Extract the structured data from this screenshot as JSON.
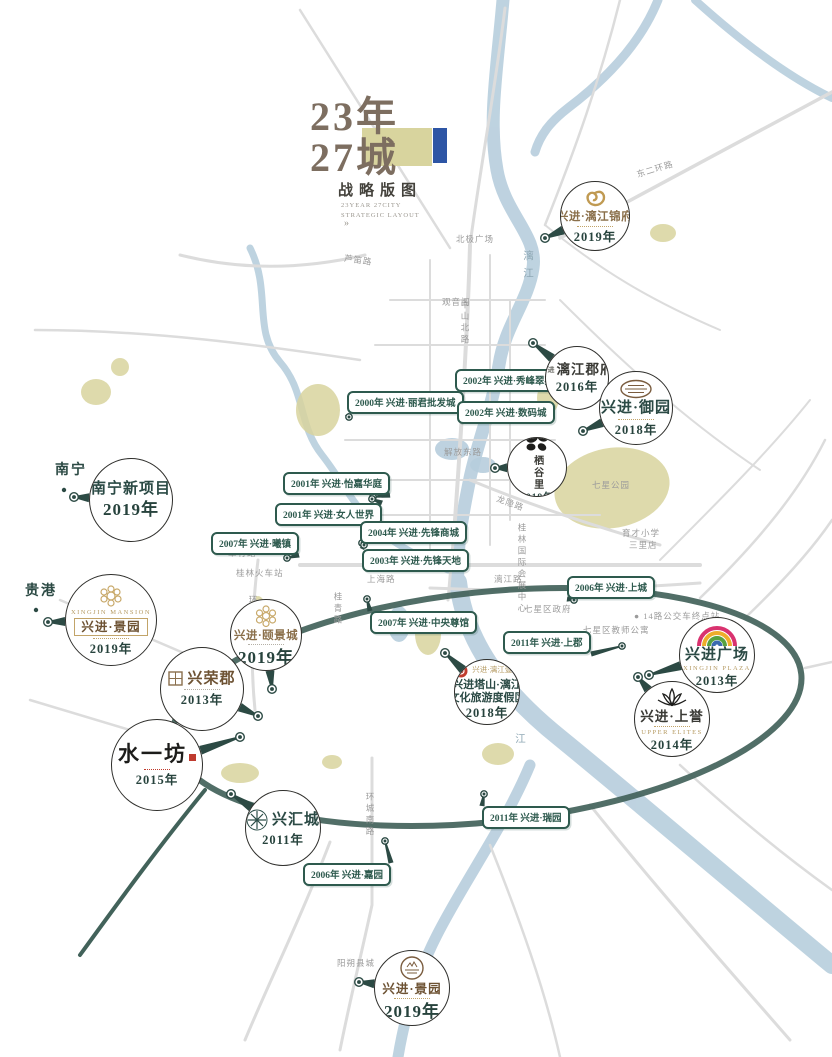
{
  "poster": {
    "title": {
      "line1": "23年",
      "line2": "27城",
      "subtitle": "战略版图",
      "eng_line1": "23YEAR 27CITY",
      "eng_line2": "STRATEGIC LAYOUT",
      "arrow": "»"
    },
    "colors": {
      "accent_teal": "#2c4a44",
      "label_green": "#2e5a4e",
      "khaki": "#d8d49e",
      "blue_bar": "#2d55a5",
      "gold": "#bd9a5f",
      "river_blue": "#b7cedd",
      "ring_road": "#42625a"
    }
  },
  "city_markers": [
    {
      "label": "南宁",
      "x": 55,
      "y": 459,
      "dot": [
        64,
        490
      ]
    },
    {
      "label": "贵港",
      "x": 25,
      "y": 580,
      "dot": [
        36,
        610
      ]
    }
  ],
  "projects": [
    {
      "id": "lijiang-jinfu",
      "name": "兴进·漓江锦府",
      "year": "2019年",
      "logo": "gold-crest-icon",
      "name_class": "callig-gold",
      "deco": "gold",
      "cx": 595,
      "cy": 216,
      "r": 35,
      "anchor": [
        545,
        238
      ]
    },
    {
      "id": "lijiang-junfu",
      "prefix": "兴进",
      "name": "漓江郡府",
      "year": "2016年",
      "logo": "",
      "name_class": "callig-dark",
      "cx": 577,
      "cy": 378,
      "r": 32,
      "anchor": [
        533,
        343
      ]
    },
    {
      "id": "xingjin-yuyuan",
      "name": "兴进·御园",
      "year": "2018年",
      "logo": "ornate-plate-icon",
      "name_class": "teal-big",
      "deco": "gold",
      "cx": 636,
      "cy": 408,
      "r": 37,
      "anchor": [
        583,
        431
      ]
    },
    {
      "id": "qiguli",
      "name": "栖谷里",
      "year": "2019年",
      "logo": "clover-icon",
      "vertical": true,
      "name_class": "callig-dark-small",
      "small_year": true,
      "cx": 537,
      "cy": 467,
      "r": 30,
      "anchor": [
        495,
        468
      ]
    },
    {
      "id": "nanning-new-project",
      "name": "南宁新项目",
      "year": "2019年",
      "logo": "",
      "name_class": "teal-big",
      "year_big": true,
      "cx": 131,
      "cy": 500,
      "r": 42,
      "anchor": [
        74,
        497
      ]
    },
    {
      "id": "guigang-jingyuan",
      "sub_top": "XINGJIN MANSION",
      "name": "兴进·景园",
      "boxed": true,
      "year": "2019年",
      "logo": "rosette-icon",
      "name_class": "callig-brown",
      "deco": "gold",
      "cx": 111,
      "cy": 620,
      "r": 46,
      "anchor": [
        48,
        622
      ]
    },
    {
      "id": "yijingcheng",
      "name": "兴进·颐景城",
      "year": "2019年",
      "logo": "flower-icon",
      "name_class": "callig-gold",
      "deco": "gray",
      "year_big": true,
      "cx": 266,
      "cy": 635,
      "r": 36,
      "anchor": [
        272,
        689
      ]
    },
    {
      "id": "xingrongjun",
      "name": "兴荣郡",
      "year": "2013年",
      "logo": "lattice-icon",
      "logo_row": true,
      "name_class": "brown-big",
      "deco": "gray",
      "cx": 202,
      "cy": 689,
      "r": 42,
      "anchor": [
        258,
        716
      ]
    },
    {
      "id": "shuiyifang",
      "name": "水一坊",
      "year": "2015年",
      "logo": "",
      "name_class": "brush",
      "seal": true,
      "deco": "red",
      "cx": 157,
      "cy": 765,
      "r": 46,
      "anchor": [
        240,
        737
      ]
    },
    {
      "id": "xinghuicheng",
      "name": "兴汇城",
      "year": "2011年",
      "logo": "medallion-icon",
      "logo_row": true,
      "name_class": "teal-big",
      "cx": 283,
      "cy": 828,
      "r": 38,
      "anchor": [
        231,
        794
      ]
    },
    {
      "id": "xingjin-plaza",
      "name": "兴进广场",
      "sub": "XINGJIN PLAZA",
      "year": "2013年",
      "logo": "rainbow-arch-icon",
      "name_class": "teal-big",
      "cx": 717,
      "cy": 655,
      "r": 38,
      "anchor": [
        649,
        675
      ]
    },
    {
      "id": "xingjin-shangyu",
      "name": "兴进·上誉",
      "sub": "UPPER ELITES",
      "year": "2014年",
      "logo": "lotus-icon",
      "name_class": "callig-dark",
      "deco": "gold",
      "cx": 672,
      "cy": 719,
      "r": 38,
      "anchor": [
        638,
        677
      ]
    },
    {
      "id": "tashan-resort",
      "logo": "red-seal-icon",
      "logo_row": true,
      "logo_text": "兴进·漓江壹号",
      "name": "兴进塔山·漓江",
      "name2": "文化旅游度假区",
      "year": "2018年",
      "name_class": "teal-small",
      "cx": 487,
      "cy": 692,
      "r": 33,
      "anchor": [
        445,
        653
      ]
    },
    {
      "id": "yangshuo-jingyuan",
      "name": "兴进·景园",
      "year": "2019年",
      "logo": "emblem-icon",
      "name_class": "callig-brown",
      "deco": "gold",
      "year_big": true,
      "cx": 412,
      "cy": 988,
      "r": 38,
      "anchor": [
        359,
        982
      ]
    }
  ],
  "timeline_labels": [
    {
      "text": "2002年 兴进·秀峰翠苑",
      "x": 455,
      "y": 369,
      "anchor": [
        452,
        398
      ]
    },
    {
      "text": "2000年 兴进·丽君批发城",
      "x": 347,
      "y": 391,
      "anchor": [
        349,
        417
      ]
    },
    {
      "text": "2002年 兴进·数码城",
      "x": 457,
      "y": 401,
      "anchor": [
        453,
        399
      ]
    },
    {
      "text": "2001年 兴进·怡嘉华庭",
      "x": 283,
      "y": 472,
      "anchor": [
        373,
        497
      ]
    },
    {
      "text": "2001年 兴进·女人世界",
      "x": 275,
      "y": 503,
      "anchor": [
        372,
        499
      ]
    },
    {
      "text": "2004年 兴进·先锋商城",
      "x": 360,
      "y": 521,
      "anchor": [
        362,
        543
      ]
    },
    {
      "text": "2003年 兴进·先锋天地",
      "x": 362,
      "y": 549,
      "anchor": [
        364,
        545
      ]
    },
    {
      "text": "2007年 兴进·曦镇",
      "x": 211,
      "y": 532,
      "anchor": [
        287,
        558
      ]
    },
    {
      "text": "2006年 兴进·上城",
      "x": 567,
      "y": 576,
      "anchor": [
        574,
        600
      ]
    },
    {
      "text": "2007年 兴进·中央尊馆",
      "x": 370,
      "y": 611,
      "anchor": [
        367,
        599
      ]
    },
    {
      "text": "2011年 兴进·上郡",
      "x": 503,
      "y": 631,
      "anchor": [
        622,
        646
      ]
    },
    {
      "text": "2011年 兴进·瑞园",
      "x": 482,
      "y": 806,
      "anchor": [
        484,
        794
      ]
    },
    {
      "text": "2006年 兴进·嘉园",
      "x": 303,
      "y": 863,
      "anchor": [
        385,
        841
      ]
    }
  ],
  "road_labels": [
    {
      "text": "东二环路",
      "x": 636,
      "y": 163,
      "rot": -17
    },
    {
      "text": "北极广场",
      "x": 456,
      "y": 233
    },
    {
      "text": "芦笛路",
      "x": 344,
      "y": 254,
      "rot": 8
    },
    {
      "text": "中山北路",
      "x": 459,
      "y": 300,
      "vert": true
    },
    {
      "text": "漓江",
      "x": 520,
      "y": 250,
      "vert": true,
      "cls": "river"
    },
    {
      "text": "观音阁",
      "x": 442,
      "y": 296
    },
    {
      "text": "解放东路",
      "x": 444,
      "y": 446
    },
    {
      "text": "上海路",
      "x": 367,
      "y": 573
    },
    {
      "text": "漓江路",
      "x": 494,
      "y": 573
    },
    {
      "text": "龙隐路",
      "x": 496,
      "y": 497,
      "rot": 20
    },
    {
      "text": "桂青路",
      "x": 332,
      "y": 592,
      "vert": true
    },
    {
      "text": "环城西一路",
      "x": 247,
      "y": 595,
      "vert": true
    },
    {
      "text": "环城南路",
      "x": 364,
      "y": 792,
      "vert": true
    },
    {
      "text": "桂林火车站",
      "x": 236,
      "y": 567
    },
    {
      "text": "翠竹路",
      "x": 228,
      "y": 547
    },
    {
      "text": "三里店",
      "x": 629,
      "y": 539
    },
    {
      "text": "育才小学",
      "x": 622,
      "y": 527
    },
    {
      "text": "七星公园",
      "x": 592,
      "y": 479
    },
    {
      "text": "七星区政府",
      "x": 524,
      "y": 603
    },
    {
      "text": "七星区教师公寓",
      "x": 583,
      "y": 624
    },
    {
      "text": "● 14路公交车终点站",
      "x": 634,
      "y": 610
    },
    {
      "text": "桂林国际会展中心",
      "x": 516,
      "y": 523,
      "vert": true
    },
    {
      "text": "阳朔县城",
      "x": 337,
      "y": 957
    },
    {
      "text": "江",
      "x": 512,
      "y": 733,
      "vert": true,
      "cls": "river"
    }
  ]
}
